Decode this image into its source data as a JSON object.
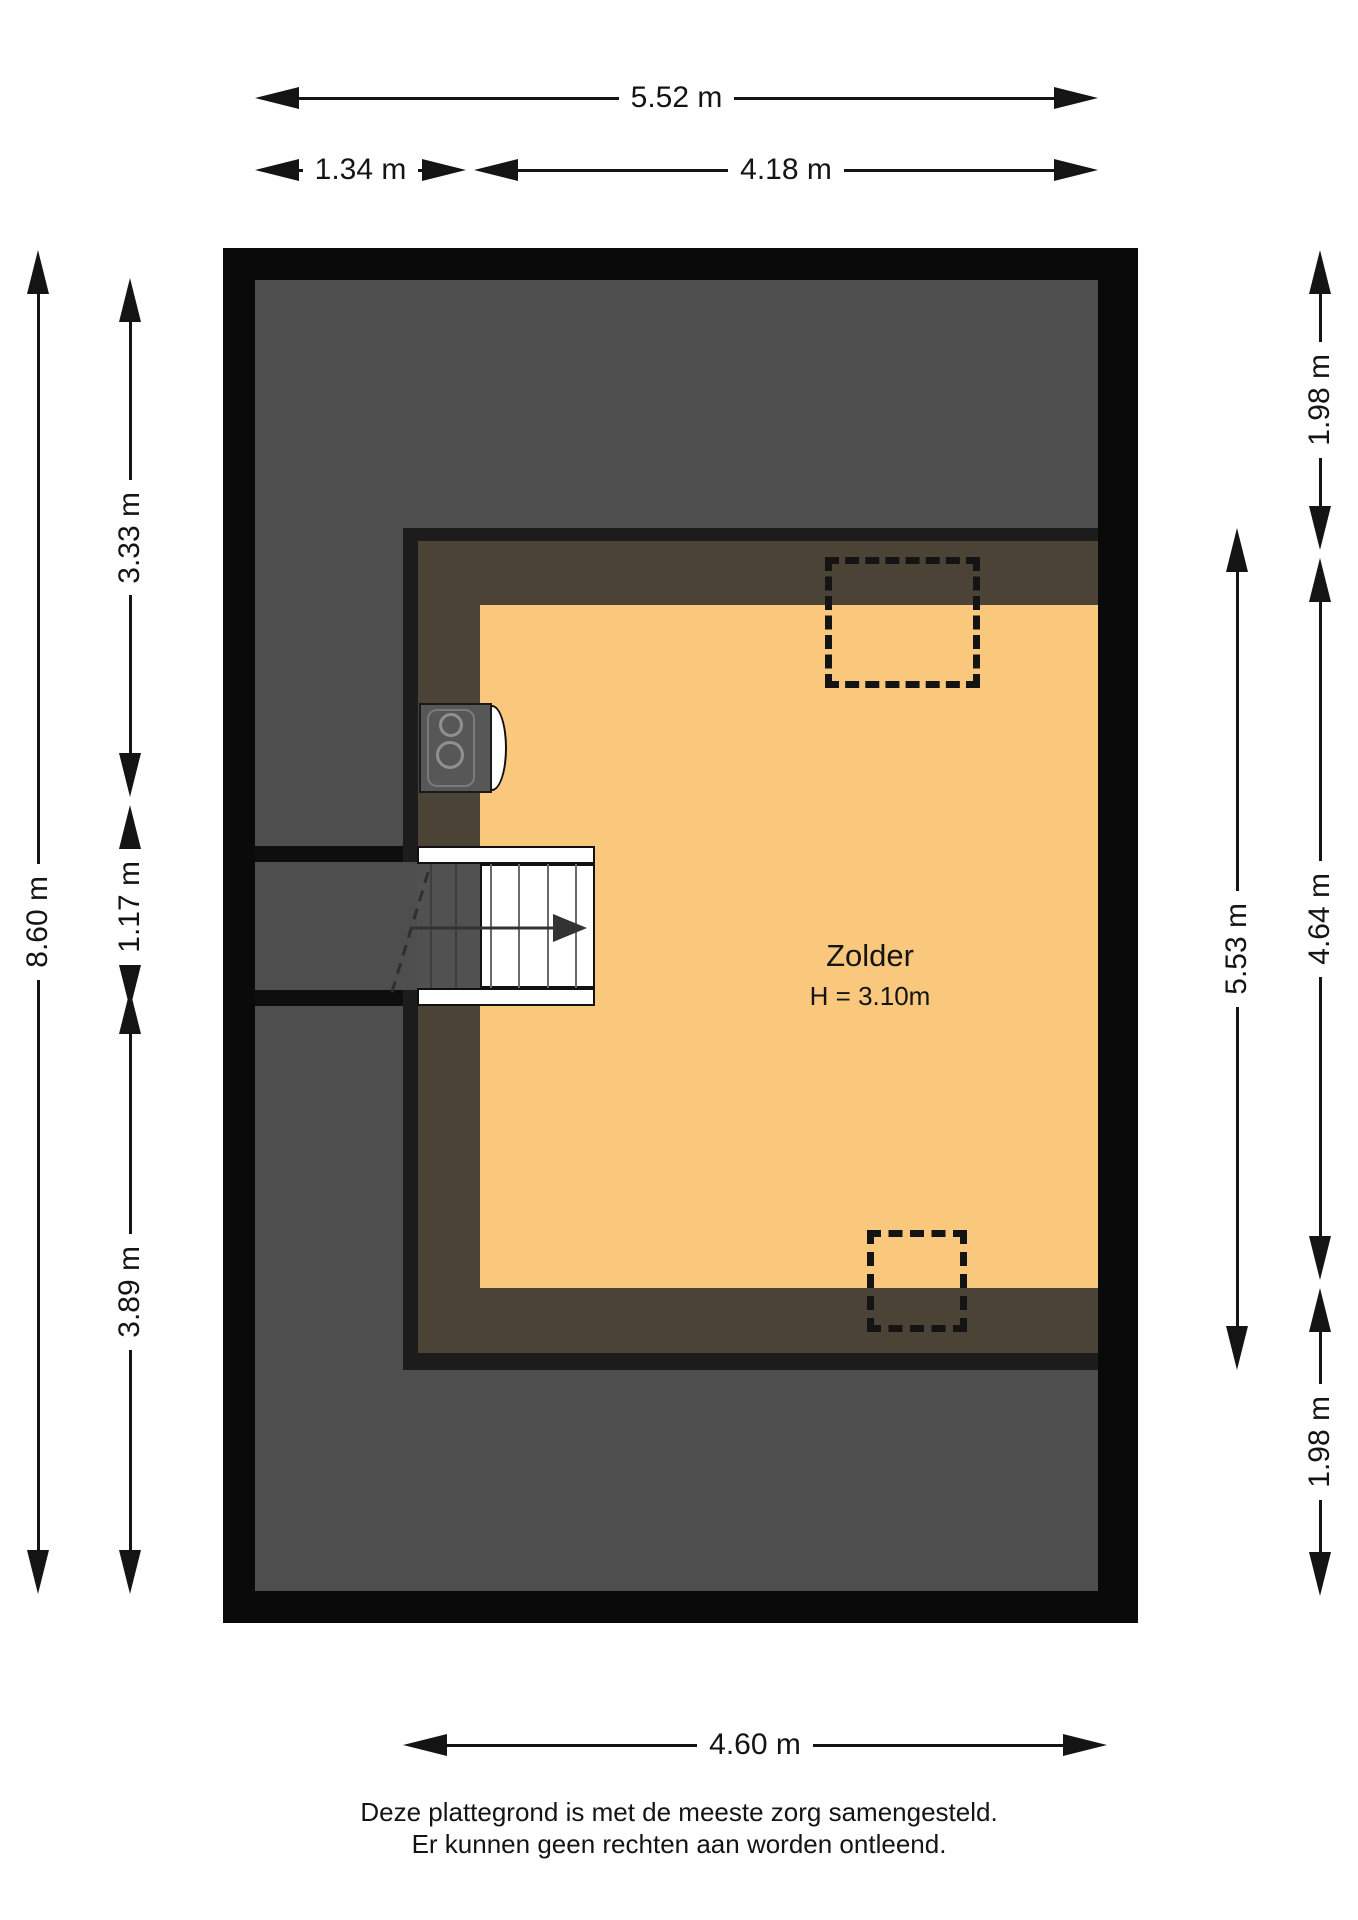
{
  "plan": {
    "room": {
      "name": "Zolder",
      "height": "H = 3.10m"
    },
    "dimensions": {
      "top_total": "5.52 m",
      "top_left": "1.34 m",
      "top_right": "4.18 m",
      "left_total": "8.60 m",
      "left_seg1": "3.33 m",
      "left_seg2": "1.17 m",
      "left_seg3": "3.89 m",
      "right_room": "5.53 m",
      "right_seg1": "1.98 m",
      "right_seg2": "4.64 m",
      "right_seg3": "1.98 m",
      "bottom": "4.60 m"
    },
    "disclaimer": [
      "Deze plattegrond is met de meeste zorg samengesteld.",
      "Er kunnen geen rechten aan worden ontleend."
    ],
    "colors": {
      "floor": "#f9c87d",
      "outer_wall": "#0a0a0a",
      "roof_area": "#4e4e4e",
      "knee_wall_zone": "#4b4335"
    }
  }
}
